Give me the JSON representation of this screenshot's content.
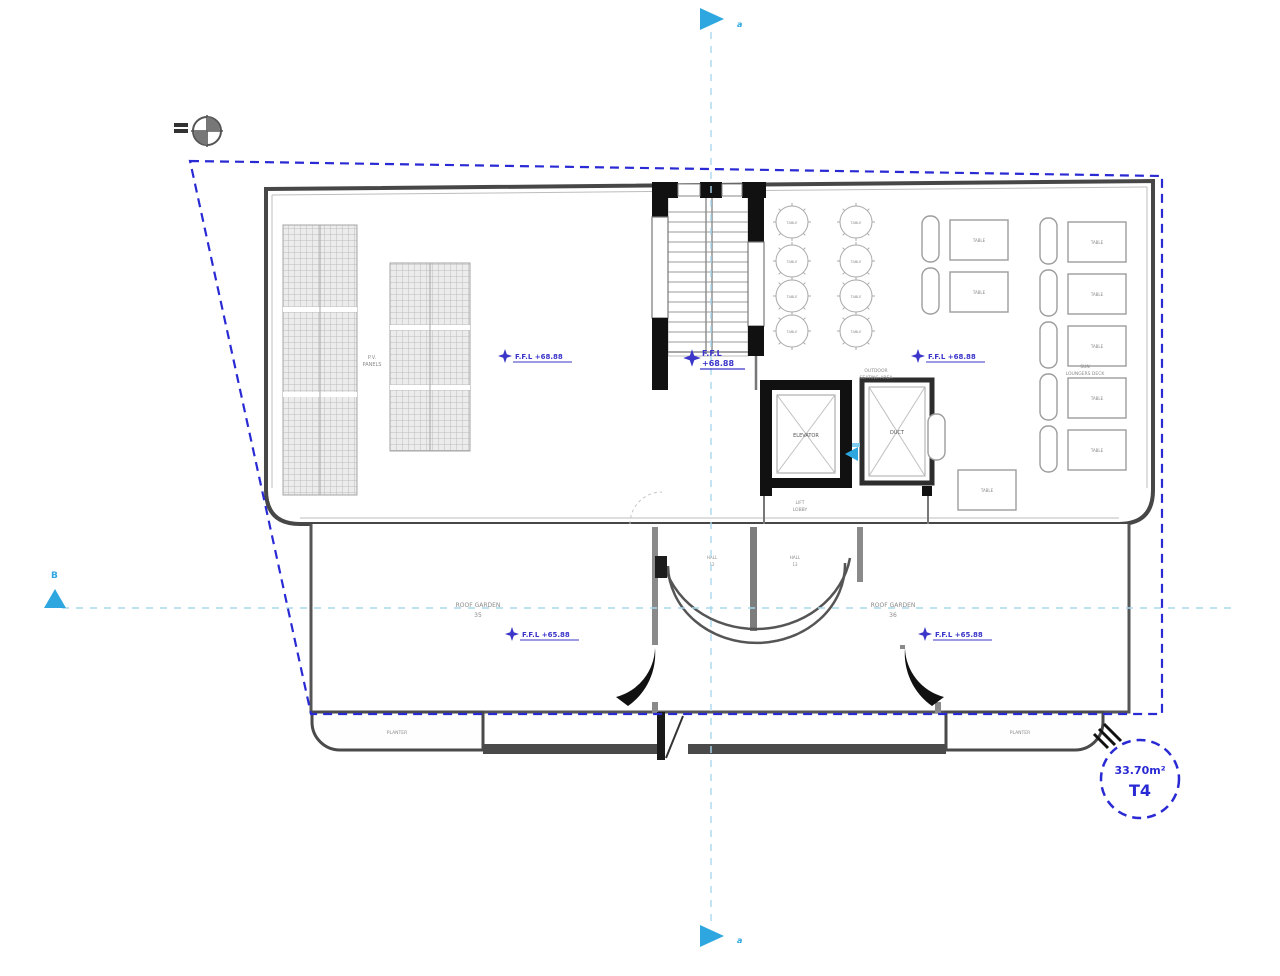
{
  "drawing": {
    "kind": "architectural roof floor plan"
  },
  "markers": {
    "top": "a",
    "bottom": "a",
    "left": "B"
  },
  "badge": {
    "area": "33.70m²",
    "type": "T4"
  },
  "levels": {
    "roof": "F.F.L +68.88",
    "stair_line1": "F.F.L",
    "stair_line2": "+68.88",
    "terrace": "F.F.L +65.88"
  },
  "labels": {
    "pv_line1": "P.V.",
    "pv_line2": "PANELS",
    "seating_line1": "OUTDOOR",
    "seating_line2": "SEATING AREA",
    "deck_line1": "SUN",
    "deck_line2": "LOUNGERS DECK",
    "elevator": "ELEVATOR",
    "duct": "DUCT",
    "lobby_line1": "LIFT",
    "lobby_line2": "LOBBY",
    "hall_left_line1": "HALL",
    "hall_left_line2": "12",
    "hall_right_line1": "HALL",
    "hall_right_line2": "13",
    "room_left_name": "ROOF GARDEN",
    "room_left_no": "35",
    "room_right_name": "ROOF GARDEN",
    "room_right_no": "36",
    "planter_left": "PLANTER",
    "planter_right": "PLANTER",
    "table": "TABLE",
    "round_table": "TABLE"
  }
}
